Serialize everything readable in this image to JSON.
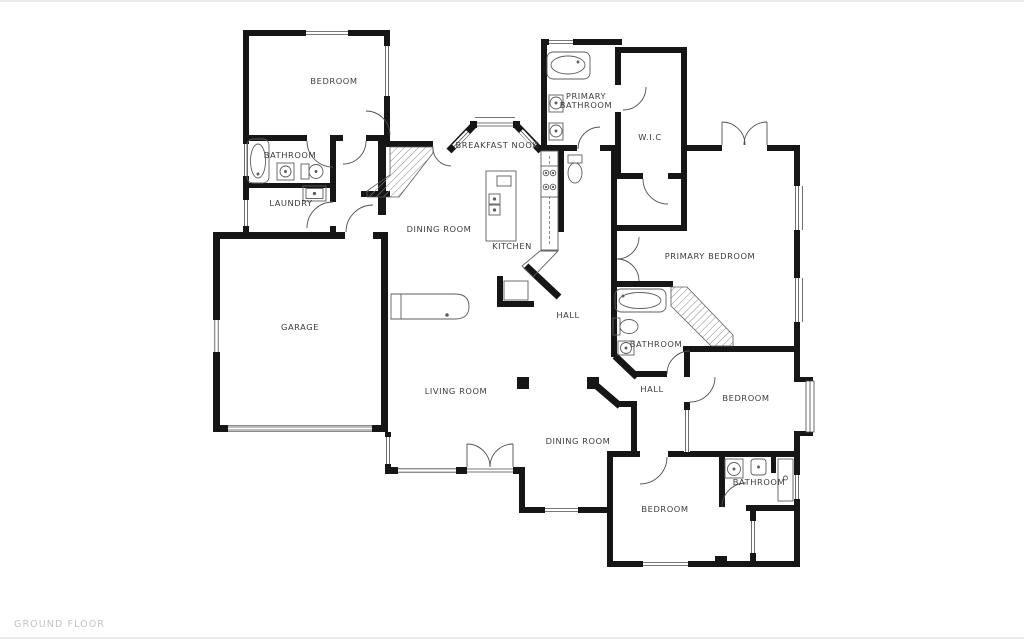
{
  "floor_plan": {
    "title": "GROUND FLOOR",
    "rooms": {
      "bedroom_top_left": "BEDROOM",
      "bathroom_left": "BATHROOM",
      "laundry": "LAUNDRY",
      "garage": "GARAGE",
      "dining_room_upper": "DINING ROOM",
      "breakfast_nook": "BREAKFAST NOOK",
      "kitchen": "KITCHEN",
      "primary_bathroom_line1": "PRIMARY",
      "primary_bathroom_line2": "BATHROOM",
      "wic": "W.I.C",
      "primary_bedroom": "PRIMARY BEDROOM",
      "hall_center": "HALL",
      "bathroom_middle": "BATHROOM",
      "hall_lower": "HALL",
      "bedroom_middle_right": "BEDROOM",
      "living_room": "LIVING ROOM",
      "dining_room_lower": "DINING ROOM",
      "bedroom_bottom": "BEDROOM",
      "bathroom_bottom_right": "BATHROOM"
    },
    "colors": {
      "wall": "#161616",
      "label": "#3c3c3c",
      "floor_title": "#c2c2c2",
      "background": "#ffffff"
    }
  }
}
